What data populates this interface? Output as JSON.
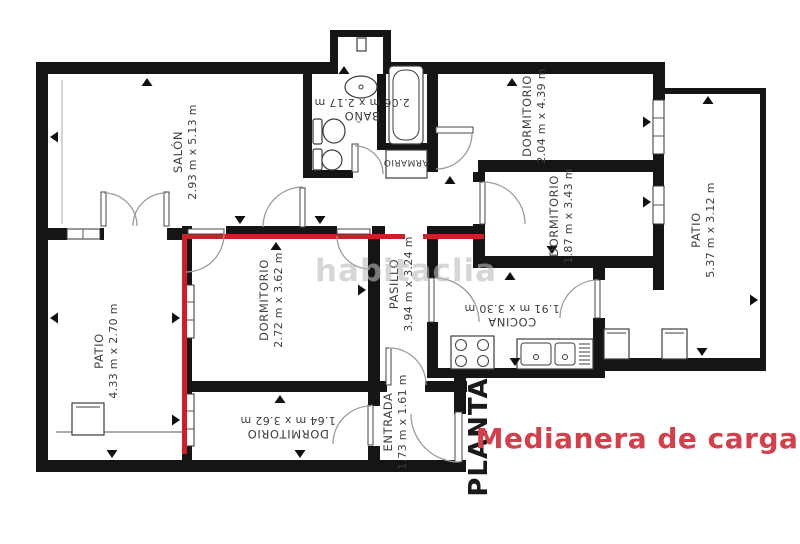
{
  "watermark": {
    "text": "habitaclia"
  },
  "annotations": {
    "floor_label": "PLANTA",
    "legend": {
      "text": "Medianera de carga"
    }
  },
  "colors": {
    "wall": "#151515",
    "medianera_line": "#c92128",
    "legend_text": "#d2414b",
    "label_text": "#3d3d3d",
    "door_arc": "#9b9b9b",
    "watermark": "#bcbcbc"
  },
  "rooms": {
    "salon": {
      "name": "SALÓN",
      "dimensions": "2.93 m x 5.13 m"
    },
    "bano": {
      "name": "BAÑO",
      "dimensions": "2.06 m x 2.17 m"
    },
    "armario": {
      "name": "ARMARIO"
    },
    "dormitorio_top": {
      "name": "DORMITORIO",
      "dimensions": "2.04 m x 4.39 m"
    },
    "dormitorio_right": {
      "name": "DORMITORIO",
      "dimensions": "1.87 m x 3.43 m"
    },
    "patio_right": {
      "name": "PATIO",
      "dimensions": "5.37 m x 3.12 m"
    },
    "patio_left": {
      "name": "PATIO",
      "dimensions": "4.33 m x 2.70 m"
    },
    "dormitorio_center": {
      "name": "DORMITORIO",
      "dimensions": "2.72 m x 3.62 m"
    },
    "pasillo": {
      "name": "PASILLO",
      "dimensions": "3.94 m x 3.24 m"
    },
    "cocina": {
      "name": "COCINA",
      "dimensions": "1.91 m x 3.30 m"
    },
    "dormitorio_bottom": {
      "name": "DORMITORIO",
      "dimensions": "1.64 m x 3.62 m"
    },
    "entrada": {
      "name": "ENTRADA",
      "dimensions": "1.73 m x 1.61 m"
    }
  }
}
